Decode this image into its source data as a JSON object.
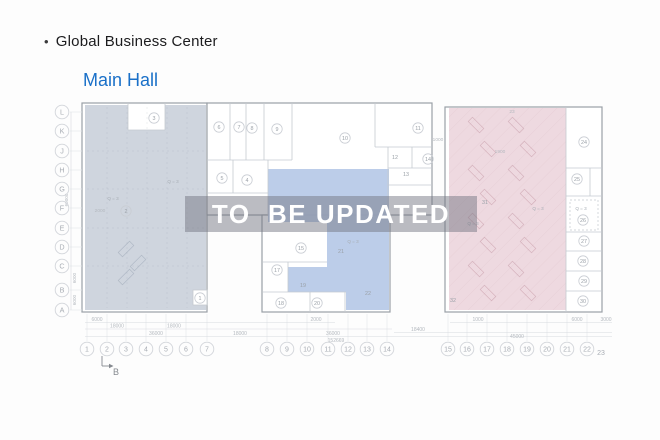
{
  "header": {
    "bullet": "•",
    "title": "Global Business Center",
    "subtitle": "Main Hall",
    "subtitle_color": "#1a70c8",
    "title_color": "#1c1c1e"
  },
  "watermark": {
    "text": "TO  BE UPDATED",
    "text_color": "#ffffff",
    "band_color": "rgba(112,116,127,0.48)"
  },
  "plan": {
    "colors": {
      "block_stroke": "#9aa0a7",
      "wall": "#c5cad0",
      "zone_left": "#ccd3dc",
      "zone_center": "#b8cae8",
      "zone_right": "#edd7de",
      "axis_stroke": "#d2d5da",
      "axis_text": "#a8adb4",
      "room_stroke": "#c9cdd3",
      "room_text": "#9ba1a8",
      "dim_text": "#b4b9bf",
      "dim_line": "#d8dbdf",
      "ext_line": "#e3e6ea",
      "marker": "#85898f"
    },
    "blocks": [
      [
        82,
        103,
        125,
        209
      ],
      [
        207,
        103,
        225,
        112
      ],
      [
        262,
        215,
        128,
        97
      ],
      [
        445,
        107,
        157,
        205
      ]
    ],
    "regions": [
      {
        "name": "zone-left",
        "color": "#ccd3dc",
        "points": [
          [
            85,
            105
          ],
          [
            128,
            105
          ],
          [
            128,
            130
          ],
          [
            165,
            130
          ],
          [
            165,
            105
          ],
          [
            206,
            105
          ],
          [
            206,
            310
          ],
          [
            85,
            310
          ]
        ],
        "hatch": false
      },
      {
        "name": "zone-center",
        "color": "#b8cae8",
        "points": [
          [
            268,
            169
          ],
          [
            389,
            169
          ],
          [
            389,
            310
          ],
          [
            346,
            310
          ],
          [
            346,
            292
          ],
          [
            288,
            292
          ],
          [
            288,
            267
          ],
          [
            327,
            267
          ],
          [
            327,
            222
          ],
          [
            268,
            222
          ]
        ],
        "hatch": false
      },
      {
        "name": "zone-right",
        "color": "#edd7de",
        "points": [
          [
            449,
            108
          ],
          [
            566,
            108
          ],
          [
            566,
            310
          ],
          [
            449,
            310
          ]
        ],
        "hatch": true
      }
    ],
    "walls": [
      [
        128,
        103,
        128,
        130
      ],
      [
        165,
        103,
        165,
        130
      ],
      [
        128,
        130,
        165,
        130
      ],
      [
        230,
        103,
        230,
        160
      ],
      [
        246,
        103,
        246,
        160
      ],
      [
        264,
        103,
        264,
        160
      ],
      [
        292,
        103,
        292,
        160
      ],
      [
        207,
        160,
        292,
        160
      ],
      [
        233,
        160,
        233,
        193
      ],
      [
        207,
        193,
        268,
        193
      ],
      [
        268,
        160,
        268,
        215
      ],
      [
        375,
        103,
        375,
        147
      ],
      [
        375,
        147,
        432,
        147
      ],
      [
        388,
        147,
        388,
        215
      ],
      [
        388,
        168,
        432,
        168
      ],
      [
        388,
        185,
        432,
        185
      ],
      [
        412,
        147,
        412,
        168
      ],
      [
        263,
        262,
        327,
        262
      ],
      [
        288,
        262,
        288,
        292
      ],
      [
        263,
        292,
        346,
        292
      ],
      [
        310,
        292,
        310,
        312
      ],
      [
        345,
        292,
        345,
        312
      ],
      [
        566,
        107,
        566,
        312
      ],
      [
        566,
        168,
        602,
        168
      ],
      [
        566,
        196,
        602,
        196
      ],
      [
        566,
        232,
        602,
        232
      ],
      [
        566,
        251,
        602,
        251
      ],
      [
        566,
        271,
        602,
        271
      ],
      [
        566,
        291,
        602,
        291
      ],
      [
        590,
        168,
        590,
        196
      ]
    ],
    "white_boxes": [
      [
        193,
        290,
        14,
        15
      ]
    ],
    "dashed_boxes": [
      [
        570,
        200,
        28,
        30
      ]
    ],
    "grid_dashed": [
      [
        107,
        107,
        107,
        308
      ],
      [
        127,
        107,
        127,
        308
      ],
      [
        147,
        107,
        147,
        308
      ],
      [
        167,
        107,
        167,
        308
      ],
      [
        187,
        107,
        187,
        308
      ],
      [
        87,
        151,
        205,
        151
      ],
      [
        87,
        189,
        205,
        189
      ],
      [
        87,
        228,
        205,
        228
      ],
      [
        87,
        266,
        205,
        266
      ]
    ],
    "dim_lines": [
      [
        85,
        322.5,
        335,
        322.5
      ],
      [
        450,
        322.5,
        612,
        322.5
      ],
      [
        85,
        329,
        392,
        329
      ],
      [
        394,
        332.5,
        612,
        332.5
      ],
      [
        85,
        336.5,
        612,
        336.5
      ],
      [
        71,
        112,
        71,
        310
      ]
    ],
    "rows": [
      {
        "label": "L",
        "y": 112
      },
      {
        "label": "K",
        "y": 131
      },
      {
        "label": "J",
        "y": 151
      },
      {
        "label": "H",
        "y": 170
      },
      {
        "label": "G",
        "y": 189
      },
      {
        "label": "F",
        "y": 208
      },
      {
        "label": "E",
        "y": 228
      },
      {
        "label": "D",
        "y": 247
      },
      {
        "label": "C",
        "y": 266
      },
      {
        "label": "B",
        "y": 290
      },
      {
        "label": "A",
        "y": 310
      }
    ],
    "rows_x": 62,
    "cols": [
      {
        "label": "1",
        "x": 87
      },
      {
        "label": "2",
        "x": 107
      },
      {
        "label": "3",
        "x": 126
      },
      {
        "label": "4",
        "x": 146
      },
      {
        "label": "5",
        "x": 166
      },
      {
        "label": "6",
        "x": 186
      },
      {
        "label": "7",
        "x": 207
      },
      {
        "label": "8",
        "x": 267
      },
      {
        "label": "9",
        "x": 287
      },
      {
        "label": "10",
        "x": 307
      },
      {
        "label": "11",
        "x": 328
      },
      {
        "label": "12",
        "x": 348
      },
      {
        "label": "13",
        "x": 367
      },
      {
        "label": "14",
        "x": 387
      },
      {
        "label": "15",
        "x": 448
      },
      {
        "label": "16",
        "x": 467
      },
      {
        "label": "17",
        "x": 487
      },
      {
        "label": "18",
        "x": 507
      },
      {
        "label": "19",
        "x": 527
      },
      {
        "label": "20",
        "x": 547
      },
      {
        "label": "21",
        "x": 567
      },
      {
        "label": "22",
        "x": 587
      }
    ],
    "cols_y": 349,
    "col_plain": {
      "label": "23",
      "x": 601,
      "y": 355
    },
    "rooms": [
      {
        "n": "1",
        "x": 200,
        "y": 298,
        "c": true
      },
      {
        "n": "2",
        "x": 126,
        "y": 211,
        "c": true
      },
      {
        "n": "3",
        "x": 154,
        "y": 118,
        "c": true
      },
      {
        "n": "4",
        "x": 247,
        "y": 180,
        "c": true
      },
      {
        "n": "5",
        "x": 222,
        "y": 178,
        "c": true
      },
      {
        "n": "6",
        "x": 219,
        "y": 127,
        "c": true
      },
      {
        "n": "7",
        "x": 239,
        "y": 127,
        "c": true
      },
      {
        "n": "8",
        "x": 252,
        "y": 128,
        "c": true
      },
      {
        "n": "9",
        "x": 277,
        "y": 129,
        "c": true
      },
      {
        "n": "10",
        "x": 345,
        "y": 138,
        "c": true
      },
      {
        "n": "11",
        "x": 418,
        "y": 128,
        "c": true
      },
      {
        "n": "12",
        "x": 395,
        "y": 157,
        "c": false
      },
      {
        "n": "13",
        "x": 406,
        "y": 174,
        "c": false
      },
      {
        "n": "14",
        "x": 428,
        "y": 159,
        "c": true
      },
      {
        "n": "15",
        "x": 301,
        "y": 248,
        "c": true
      },
      {
        "n": "17",
        "x": 277,
        "y": 270,
        "c": true
      },
      {
        "n": "18",
        "x": 281,
        "y": 303,
        "c": true
      },
      {
        "n": "19",
        "x": 303,
        "y": 285,
        "c": false
      },
      {
        "n": "20",
        "x": 317,
        "y": 303,
        "c": true
      },
      {
        "n": "21",
        "x": 341,
        "y": 251,
        "c": false
      },
      {
        "n": "22",
        "x": 368,
        "y": 293,
        "c": false
      },
      {
        "n": "24",
        "x": 584,
        "y": 142,
        "c": true
      },
      {
        "n": "25",
        "x": 577,
        "y": 179,
        "c": true
      },
      {
        "n": "26",
        "x": 583,
        "y": 220,
        "c": true
      },
      {
        "n": "27",
        "x": 584,
        "y": 241,
        "c": true
      },
      {
        "n": "28",
        "x": 583,
        "y": 261,
        "c": true
      },
      {
        "n": "29",
        "x": 584,
        "y": 281,
        "c": true
      },
      {
        "n": "30",
        "x": 583,
        "y": 301,
        "c": true
      },
      {
        "n": "31",
        "x": 485,
        "y": 202,
        "c": false
      },
      {
        "n": "32",
        "x": 453,
        "y": 300,
        "c": false
      }
    ],
    "q_text": "Q = 3",
    "q_labels": [
      {
        "x": 173,
        "y": 183
      },
      {
        "x": 113,
        "y": 200
      },
      {
        "x": 353,
        "y": 243
      },
      {
        "x": 473,
        "y": 225
      },
      {
        "x": 538,
        "y": 210
      },
      {
        "x": 581,
        "y": 210
      }
    ],
    "plan_texts": [
      {
        "t": "2000",
        "x": 100,
        "y": 212
      },
      {
        "t": "1900",
        "x": 500,
        "y": 153
      },
      {
        "t": "1000",
        "x": 438,
        "y": 141
      },
      {
        "t": "23",
        "x": 512,
        "y": 113
      }
    ],
    "dims_bottom": [
      {
        "t": "6000",
        "x": 97,
        "y": 321
      },
      {
        "t": "18000",
        "x": 117,
        "y": 327.5
      },
      {
        "t": "18000",
        "x": 174,
        "y": 327.5
      },
      {
        "t": "36000",
        "x": 156,
        "y": 335
      },
      {
        "t": "18000",
        "x": 240,
        "y": 335
      },
      {
        "t": "2000",
        "x": 316,
        "y": 321
      },
      {
        "t": "36000",
        "x": 333,
        "y": 335
      },
      {
        "t": "152669",
        "x": 336,
        "y": 342
      },
      {
        "t": "18400",
        "x": 418,
        "y": 331
      },
      {
        "t": "1000",
        "x": 478,
        "y": 321
      },
      {
        "t": "45000",
        "x": 517,
        "y": 338
      },
      {
        "t": "6000",
        "x": 577,
        "y": 321
      },
      {
        "t": "3000",
        "x": 606,
        "y": 321
      }
    ],
    "dims_left": [
      {
        "t": "60000",
        "x": 68,
        "y": 200
      },
      {
        "t": "6000",
        "x": 76,
        "y": 278
      },
      {
        "t": "6000",
        "x": 76,
        "y": 300
      }
    ],
    "section_marker": {
      "label": "B",
      "x": 113,
      "y": 375
    },
    "desks_pink": [
      [
        468,
        122
      ],
      [
        480,
        146
      ],
      [
        468,
        170
      ],
      [
        480,
        194
      ],
      [
        468,
        218
      ],
      [
        480,
        242
      ],
      [
        468,
        266
      ],
      [
        480,
        290
      ],
      [
        508,
        122
      ],
      [
        520,
        146
      ],
      [
        508,
        170
      ],
      [
        520,
        194
      ],
      [
        508,
        218
      ],
      [
        520,
        242
      ],
      [
        508,
        266
      ],
      [
        520,
        290
      ]
    ],
    "desks_gray": [
      [
        118,
        246
      ],
      [
        130,
        260
      ],
      [
        118,
        274
      ]
    ]
  }
}
